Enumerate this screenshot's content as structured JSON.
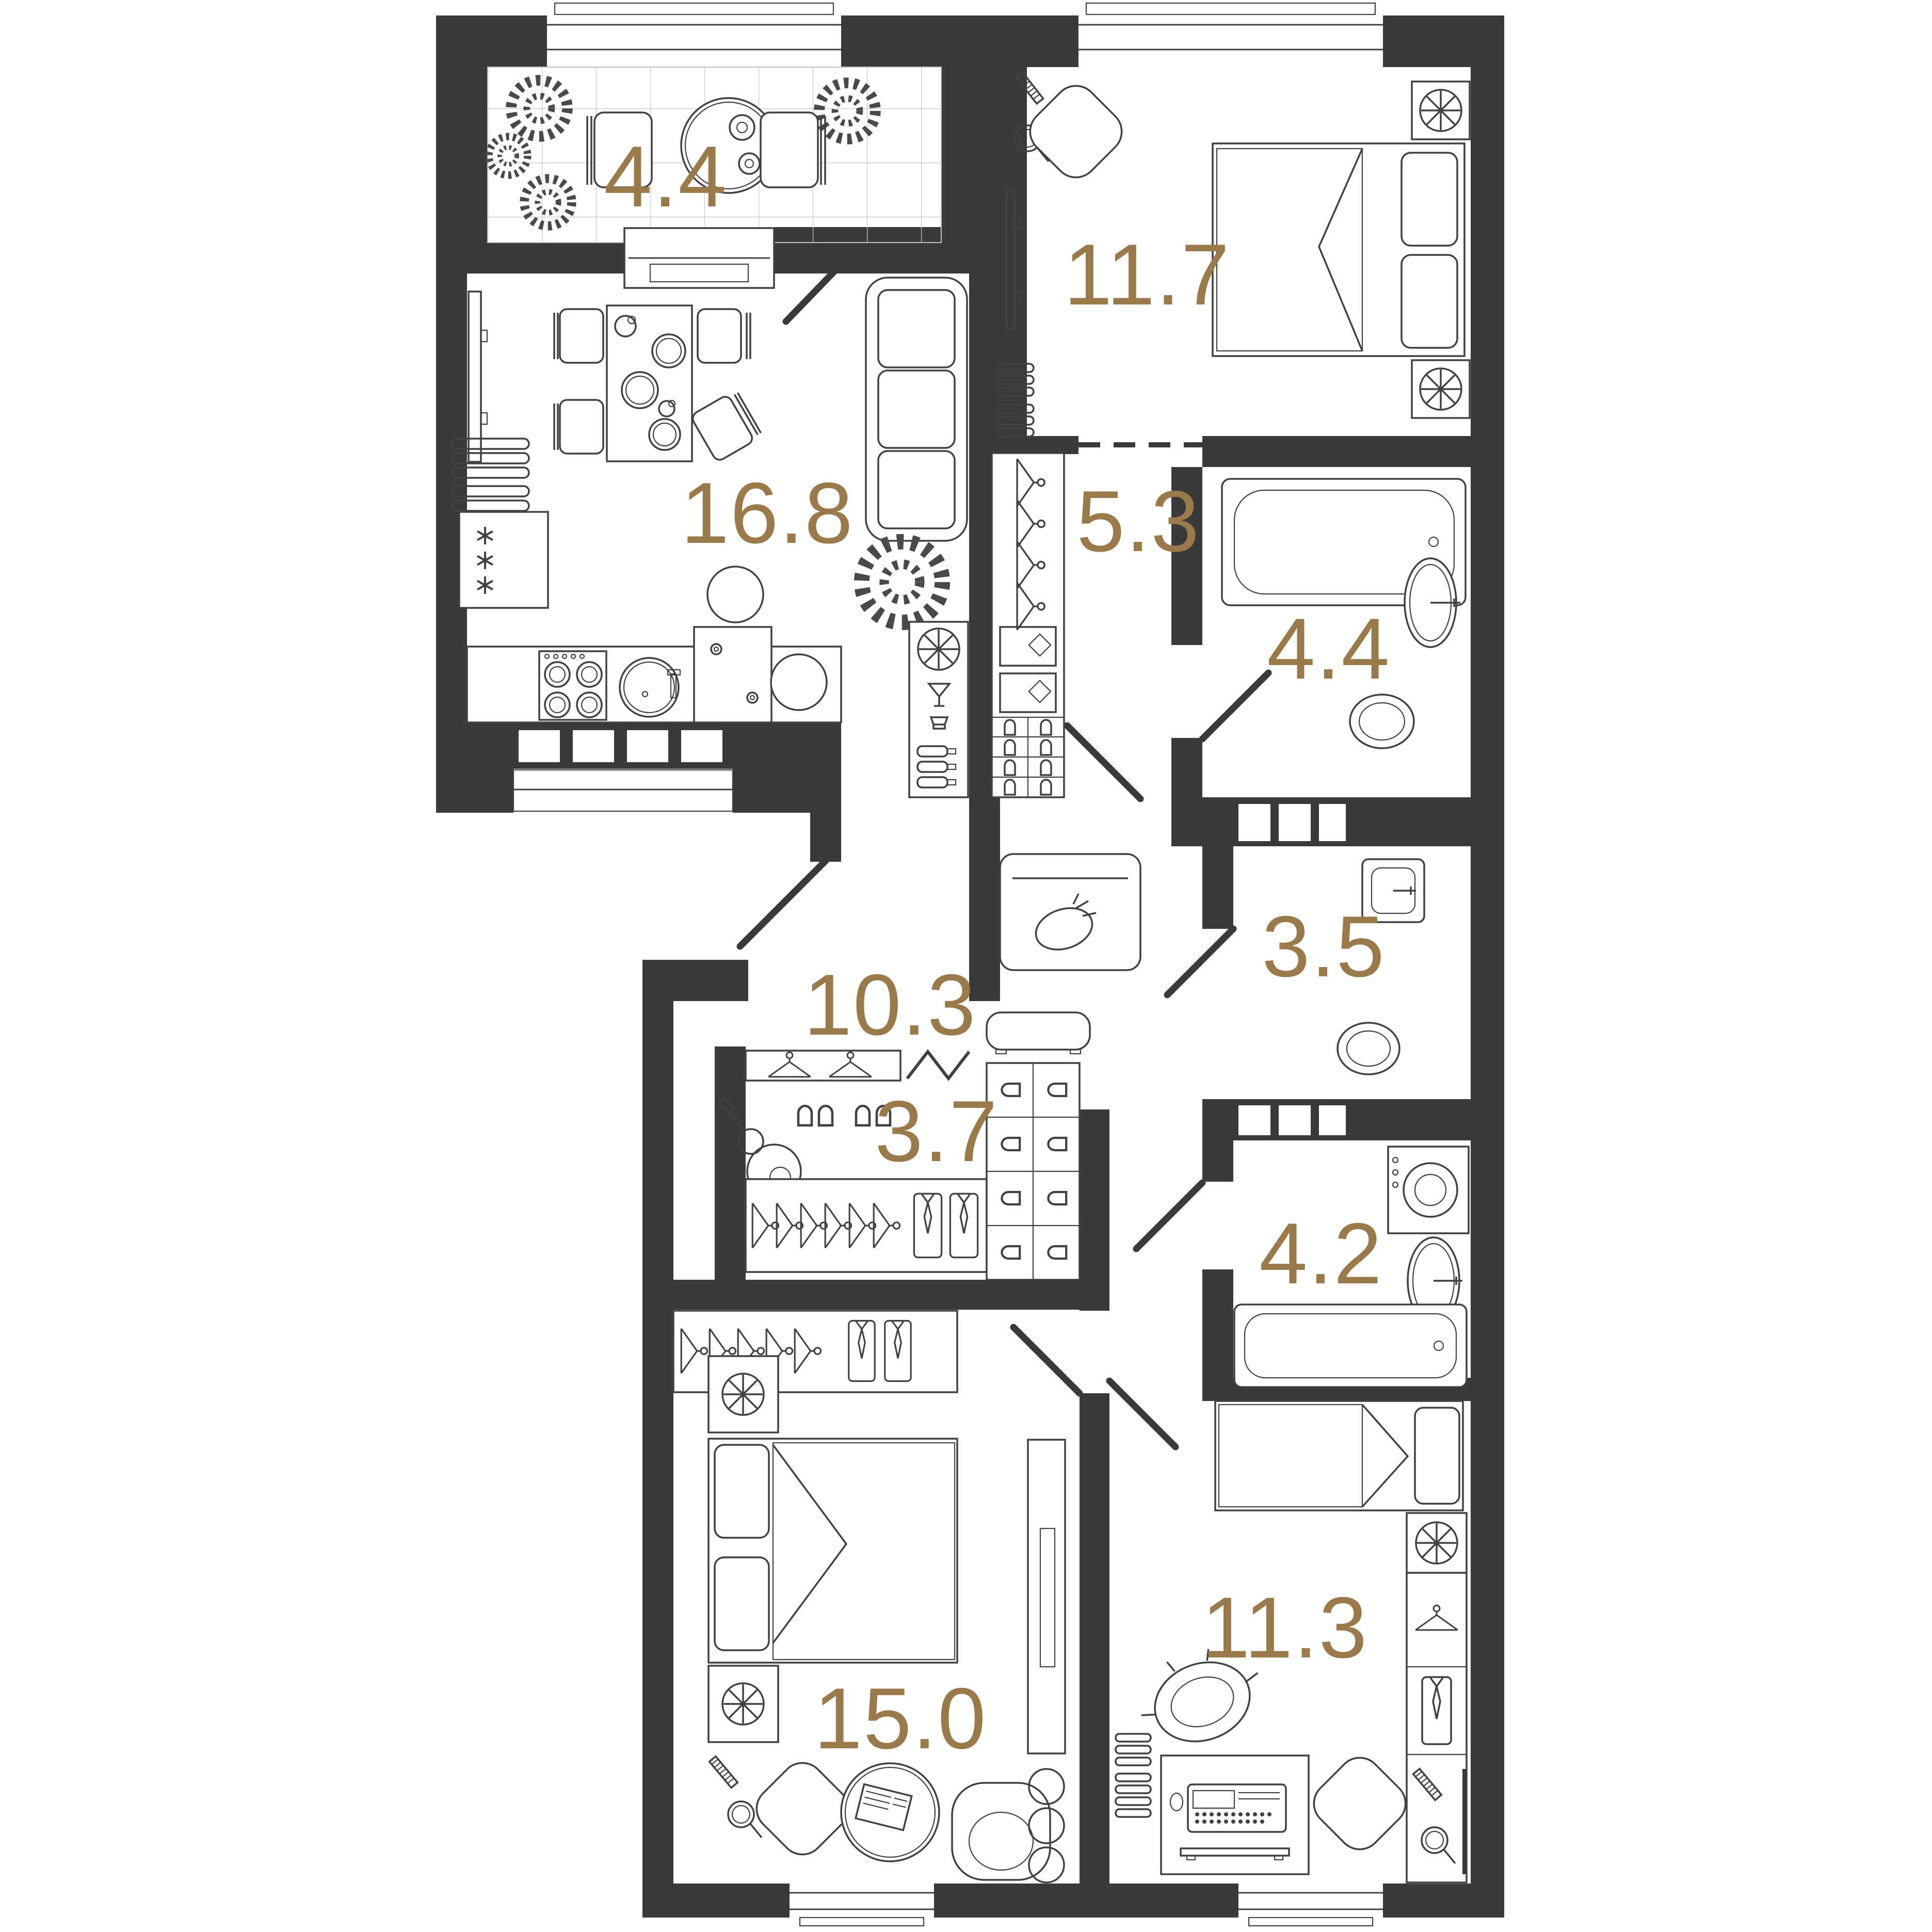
{
  "colors": {
    "wall": "#3b3a39",
    "room_label": "#9a7a4a",
    "furniture_line": "#414141",
    "tile_line": "#c9c9c9"
  },
  "rooms": [
    {
      "name": "balcony",
      "area": "4.4",
      "furniture": [
        "plant-icon",
        "round-table-icon",
        "chair-icon",
        "tiled-floor"
      ]
    },
    {
      "name": "bedroom-top",
      "area": "11.7",
      "furniture": [
        "double-bed-icon",
        "nightstand-lamp-icon",
        "tv-icon",
        "radiator-icon",
        "chair-icon",
        "mirror-icon",
        "comb-icon"
      ]
    },
    {
      "name": "kitchen-living",
      "area": "16.8",
      "furniture": [
        "sofa-icon",
        "dining-table-icon",
        "chair-icon",
        "fridge-icon",
        "stove-icon",
        "sink-icon",
        "bar-stool-icon",
        "tv-icon",
        "plant-icon",
        "bar-cabinet-icon"
      ]
    },
    {
      "name": "hallway",
      "area": "5.3",
      "furniture": [
        "wardrobe-hanger-icon",
        "shoe-shelf-icon",
        "storage-bag-icon",
        "entrance-door"
      ]
    },
    {
      "name": "bathroom-top",
      "area": "4.4",
      "furniture": [
        "bathtub-icon",
        "washbasin-icon",
        "toilet-icon"
      ]
    },
    {
      "name": "toilet-room",
      "area": "3.5",
      "furniture": [
        "washbasin-icon",
        "toilet-icon"
      ]
    },
    {
      "name": "corridor",
      "area": "10.3",
      "furniture": [
        "bench-icon",
        "door-swing"
      ]
    },
    {
      "name": "closet",
      "area": "3.7",
      "furniture": [
        "hanger-icon",
        "slipper-icon",
        "vacuum-cleaner-icon",
        "shirt-icon",
        "shoe-shelf-icon"
      ]
    },
    {
      "name": "bathroom-bottom",
      "area": "4.2",
      "furniture": [
        "washing-machine-icon",
        "washbasin-icon",
        "bathtub-icon"
      ]
    },
    {
      "name": "bedroom-left",
      "area": "15.0",
      "furniture": [
        "double-bed-icon",
        "nightstand-lamp-icon",
        "armchair-icon",
        "coffee-table-icon",
        "wardrobe-icon",
        "hanger-icon",
        "mirror-icon",
        "comb-icon"
      ]
    },
    {
      "name": "bedroom-right",
      "area": "11.3",
      "furniture": [
        "single-bed-icon",
        "desk-icon",
        "typewriter-icon",
        "chair-icon",
        "pot-icon",
        "wardrobe-icon",
        "hanger-icon",
        "shirt-icon",
        "radiator-icon"
      ]
    }
  ]
}
